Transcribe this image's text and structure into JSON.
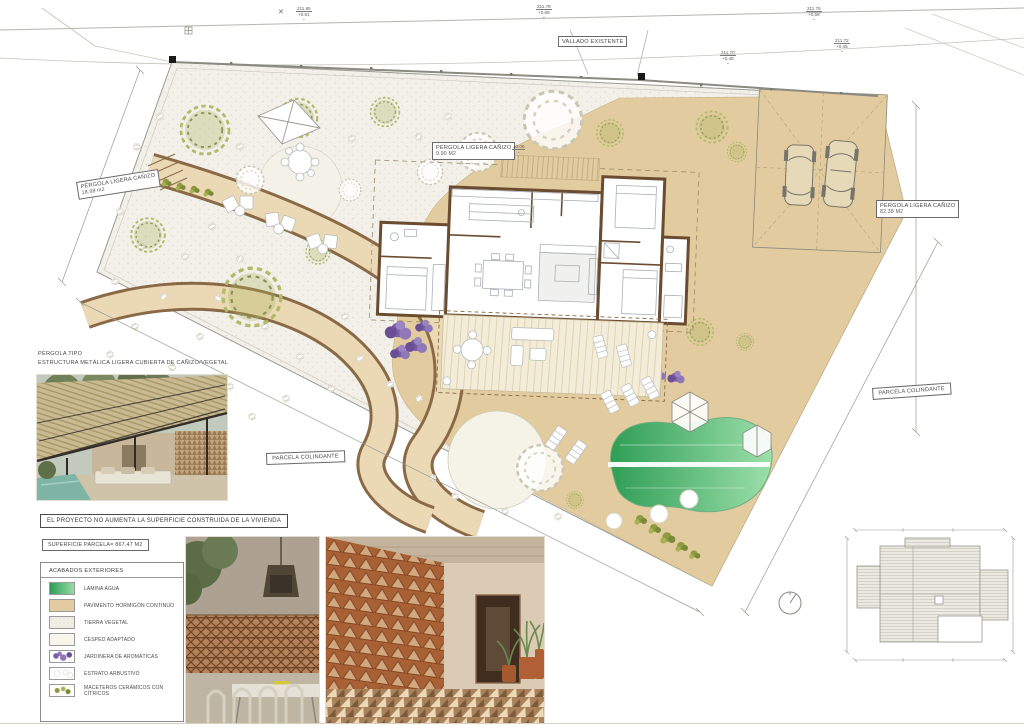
{
  "statement": "EL PROYECTO NO AUMENTA LA SUPERFICIE CONSTRUIDA DE LA VIVIENDA",
  "superficie": "SUPERFICIE PARCELA= 867.47 M2",
  "legend": {
    "title": "ACABADOS  EXTERIORES",
    "items": [
      {
        "label": "LÁMINA AGUA"
      },
      {
        "label": "PAVIMENTO HORMIGÓN CONTINUO"
      },
      {
        "label": "TIERRA VEGETAL"
      },
      {
        "label": "CESPED ADAPTADO"
      },
      {
        "label": "JARDINERA  DE AROMÁTICAS"
      },
      {
        "label": "ESTRATO ARBUSTIVO"
      },
      {
        "label": "MACETEROS CERÁMICOS CON CÍTRICOS"
      }
    ]
  },
  "pergola_note": {
    "line1": "PÉRGOLA TIPO",
    "line2": "ESTRUCTURA METÁLICA LIGERA CUBIERTA DE CAÑIZO/VEGETAL"
  },
  "plan_labels": {
    "vallado": "VALLADO EXISTENTE",
    "parcela_izq": "PARCELA COLINDANTE",
    "parcela_der": "PARCELA COLINDANTE",
    "pergola_left": {
      "l1": "PÉRGOLA LIGERA CAÑIZO",
      "l2": "18.98 m2"
    },
    "pergola_center": {
      "l1": "PÉRGOLA LIGERA CAÑIZO",
      "l2": "9.90 M2"
    },
    "pergola_right": {
      "l1": "PÉRGOLA LIGERA CAÑIZO",
      "l2": "82.38 M2"
    }
  },
  "elevation_markers": [
    {
      "a": "211.85",
      "b": "+0.81"
    },
    {
      "a": "211.78",
      "b": "+0.68"
    },
    {
      "a": "211.76",
      "b": "+0.68"
    },
    {
      "a": "211.70",
      "b": "+0.48"
    },
    {
      "a": "211.72",
      "b": "+0.45"
    },
    {
      "a": "±0.00",
      "b": ""
    }
  ],
  "colors": {
    "pavement": "#e2cc9f",
    "path_fill": "#ead9b4",
    "wall_brown": "#6b4c31",
    "pool_dark": "#2f9e55",
    "pool_light": "#96dba6",
    "aromatics_purple": "#7b5ea7",
    "olive_green": "#a8b254",
    "terracotta": "#b5693a"
  }
}
